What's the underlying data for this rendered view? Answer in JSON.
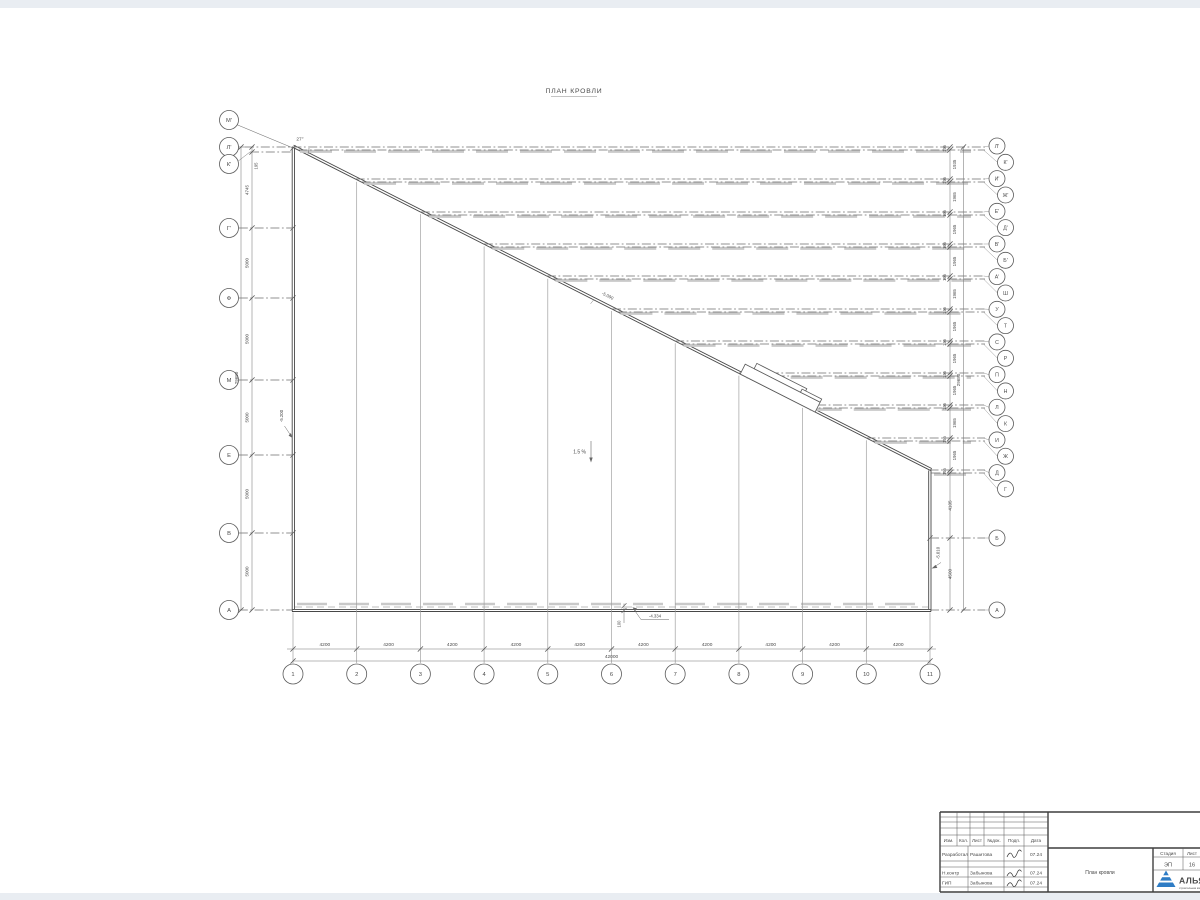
{
  "drawing": {
    "title": "ПЛАН КРОВЛИ"
  },
  "axes": {
    "left": [
      "М'",
      "Л'",
      "К'",
      "Г'",
      "Ф",
      "М",
      "Е",
      "В",
      "А"
    ],
    "right": [
      "Л'",
      "К'",
      "И'",
      "Ж'",
      "Е'",
      "Д'",
      "В'",
      "Б'",
      "А'",
      "Ш",
      "У",
      "Т",
      "С",
      "Р",
      "П",
      "Н",
      "Л",
      "К",
      "И",
      "Ж",
      "Д",
      "Г",
      "Б",
      "А"
    ],
    "bottom": [
      "1",
      "2",
      "3",
      "4",
      "5",
      "6",
      "7",
      "8",
      "9",
      "10",
      "11"
    ]
  },
  "dimensions": {
    "left_chain": [
      "195",
      "4745",
      "5000",
      "5000",
      "5000",
      "5000",
      "5000"
    ],
    "left_total": "29680",
    "right_chain": [
      "195",
      "1935",
      "195",
      "1965",
      "195",
      "1965",
      "195",
      "1965",
      "195",
      "1965",
      "195",
      "1965",
      "195",
      "1965",
      "195",
      "1965",
      "195",
      "1965",
      "195",
      "1965",
      "195",
      "4105",
      "4500"
    ],
    "right_total": "29680",
    "bottom_chain": [
      "4200",
      "4200",
      "4200",
      "4200",
      "4200",
      "4200",
      "4200",
      "4200",
      "4200",
      "4200"
    ],
    "bottom_total": "42000",
    "parapet_offset": "100"
  },
  "annotations": {
    "slope": "1.5 %",
    "angle": "27°",
    "elev_ridge": "-5.090",
    "elev_left": "-5.200",
    "elev_bottom": "-4.334",
    "elev_right": "-5.010"
  },
  "titleblock": {
    "header_cols": [
      "Изм.",
      "Кол.",
      "Лист",
      "№док.",
      "Подп.",
      "Дата"
    ],
    "rows": [
      {
        "role": "Разработал",
        "name": "Рашитова",
        "date": "07.24"
      },
      {
        "role": "Н.контр",
        "name": "Забынова",
        "date": "07.24"
      },
      {
        "role": "ГИП",
        "name": "Забынова",
        "date": "07.24"
      }
    ],
    "doc_title": "План кровли",
    "stage_label": "Стадия",
    "stage_value": "ЭП",
    "sheet_label": "Лист",
    "sheet_value": "16",
    "logo_text": "АЛЬЯНС",
    "logo_sub": "строительная компания"
  },
  "colors": {
    "line": "#4a4a4a",
    "accent": "#2e7cc5",
    "band": "#c9c9c9"
  }
}
